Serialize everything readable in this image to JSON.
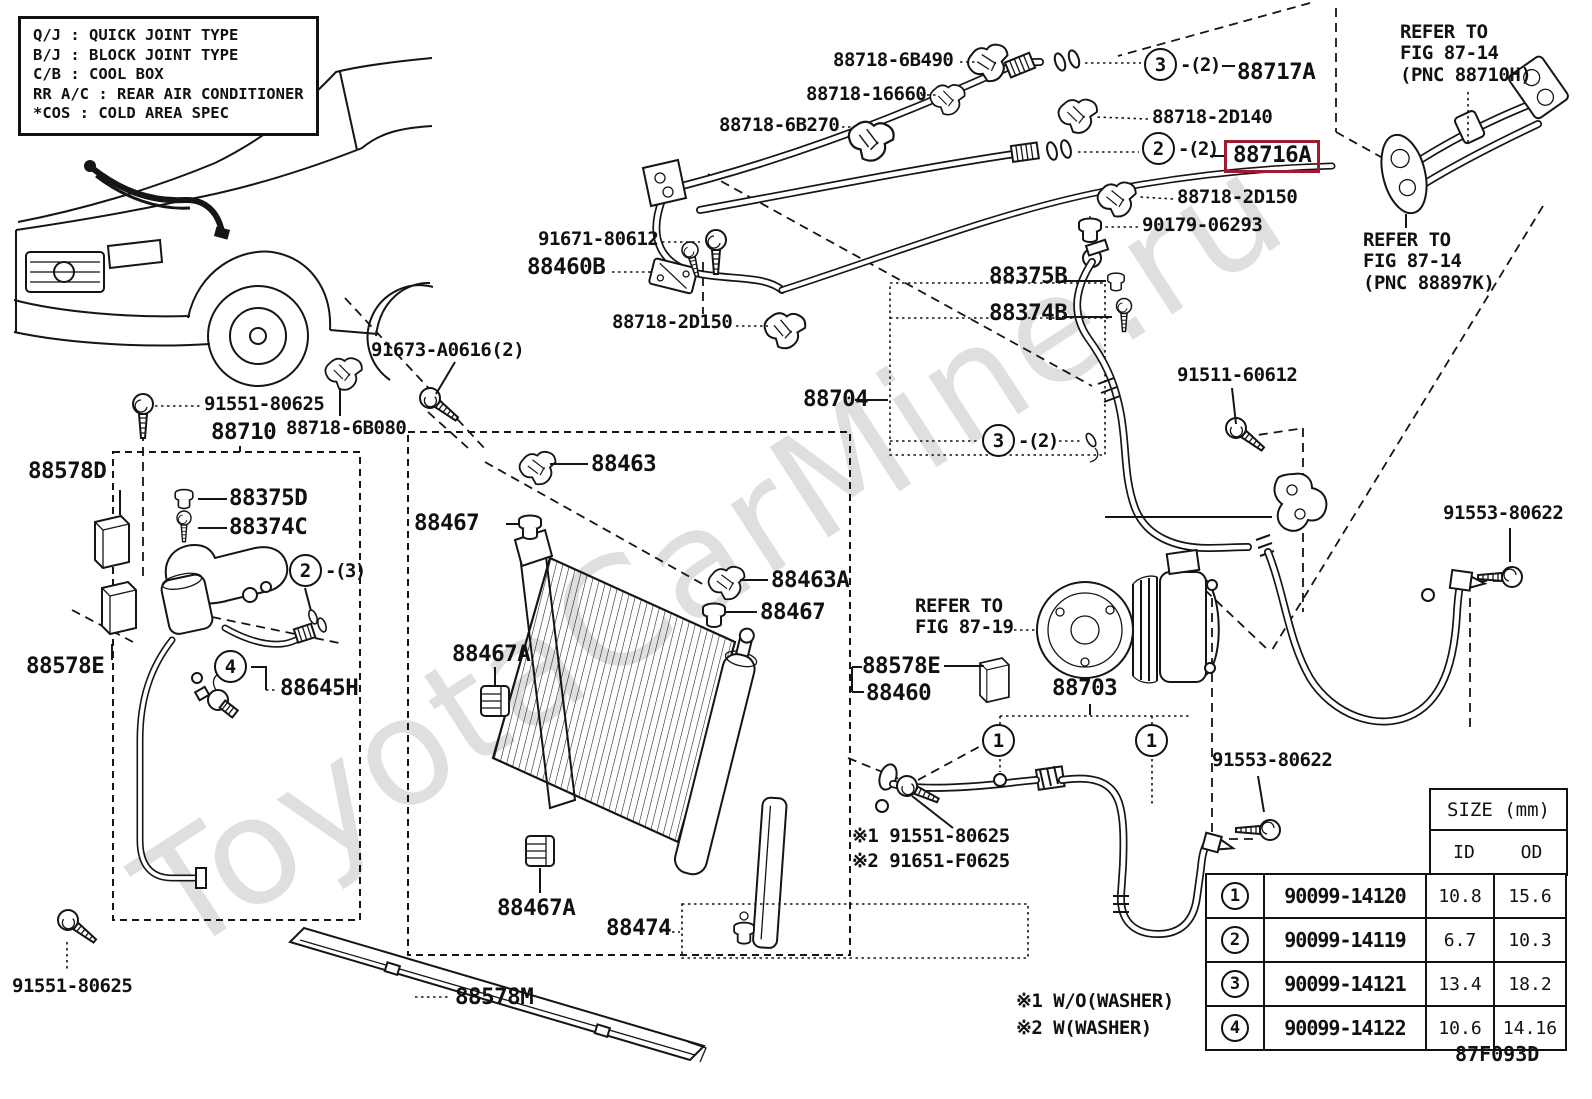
{
  "watermark": "ToyotaCarMine.ru",
  "fig_code": "87F093D",
  "highlight_color": "#a01931",
  "highlighted_part": "88716A",
  "legend": {
    "rows": [
      {
        "abbr": "Q/J",
        "desc": "QUICK JOINT TYPE"
      },
      {
        "abbr": "B/J",
        "desc": "BLOCK JOINT TYPE"
      },
      {
        "abbr": "C/B",
        "desc": "COOL BOX"
      },
      {
        "abbr": "RR A/C",
        "desc": "REAR AIR CONDITIONER"
      },
      {
        "abbr": "*COS",
        "desc": "COLD AREA SPEC"
      }
    ]
  },
  "notes": [
    "※1 W/O(WASHER)",
    "※2 W(WASHER)"
  ],
  "size_table": {
    "title": "SIZE (mm)",
    "columns": [
      "ID",
      "OD"
    ],
    "rows": [
      {
        "num": "1",
        "part_number": "90099-14120",
        "id": "10.8",
        "od": "15.6"
      },
      {
        "num": "2",
        "part_number": "90099-14119",
        "id": "6.7",
        "od": "10.3"
      },
      {
        "num": "3",
        "part_number": "90099-14121",
        "id": "13.4",
        "od": "18.2"
      },
      {
        "num": "4",
        "part_number": "90099-14122",
        "id": "10.6",
        "od": "14.16"
      }
    ]
  },
  "labels": [
    {
      "name": "part-label-88718-6b490",
      "text": "88718-6B490",
      "x": 833,
      "y": 50,
      "size": "md"
    },
    {
      "name": "part-label-88718-16660",
      "text": "88718-16660",
      "x": 806,
      "y": 84,
      "size": "md"
    },
    {
      "name": "part-label-88718-6b270",
      "text": "88718-6B270",
      "x": 719,
      "y": 115,
      "size": "md"
    },
    {
      "name": "part-label-88717a",
      "text": "88717A",
      "x": 1237,
      "y": 60,
      "size": "lg"
    },
    {
      "name": "part-label-88718-2d140",
      "text": "88718-2D140",
      "x": 1152,
      "y": 107,
      "size": "md"
    },
    {
      "name": "part-label-88716a",
      "text": "88716A",
      "x": 1224,
      "y": 140,
      "size": "lg",
      "highlight": true
    },
    {
      "name": "part-label-88718-2d150-right",
      "text": "88718-2D150",
      "x": 1177,
      "y": 187,
      "size": "md"
    },
    {
      "name": "part-label-90179-06293",
      "text": "90179-06293",
      "x": 1142,
      "y": 215,
      "size": "md"
    },
    {
      "name": "refer-note-fig-87-14-top",
      "text": "REFER TO\nFIG 87-14\n(PNC 88710H)",
      "x": 1400,
      "y": 22,
      "size": "md"
    },
    {
      "name": "refer-note-fig-87-14-bottom",
      "text": "REFER TO\nFIG 87-14\n(PNC 88897K)",
      "x": 1363,
      "y": 230,
      "size": "md"
    },
    {
      "name": "part-label-91671-80612",
      "text": "91671-80612",
      "x": 538,
      "y": 229,
      "size": "md"
    },
    {
      "name": "part-label-88460b",
      "text": "88460B",
      "x": 527,
      "y": 255,
      "size": "lg"
    },
    {
      "name": "part-label-88718-2d150-left",
      "text": "88718-2D150",
      "x": 612,
      "y": 312,
      "size": "md"
    },
    {
      "name": "part-label-88375b",
      "text": "88375B",
      "x": 989,
      "y": 264,
      "size": "lg"
    },
    {
      "name": "part-label-88374b",
      "text": "88374B",
      "x": 989,
      "y": 301,
      "size": "lg"
    },
    {
      "name": "part-label-88704",
      "text": "88704",
      "x": 803,
      "y": 387,
      "size": "lg"
    },
    {
      "name": "part-label-91511-60612",
      "text": "91511-60612",
      "x": 1177,
      "y": 365,
      "size": "md"
    },
    {
      "name": "part-label-91673-a0616",
      "text": "91673-A0616(2)",
      "x": 371,
      "y": 340,
      "size": "md"
    },
    {
      "name": "part-label-91551-80625-top",
      "text": "91551-80625",
      "x": 204,
      "y": 394,
      "size": "md"
    },
    {
      "name": "part-label-88710",
      "text": "88710",
      "x": 211,
      "y": 420,
      "size": "lg"
    },
    {
      "name": "part-label-88718-6b080",
      "text": "88718-6B080",
      "x": 286,
      "y": 418,
      "size": "md"
    },
    {
      "name": "part-label-88578d",
      "text": "88578D",
      "x": 28,
      "y": 459,
      "size": "lg"
    },
    {
      "name": "part-label-88375d",
      "text": "88375D",
      "x": 229,
      "y": 486,
      "size": "lg"
    },
    {
      "name": "part-label-88374c",
      "text": "88374C",
      "x": 229,
      "y": 515,
      "size": "lg"
    },
    {
      "name": "part-label-88578e-left",
      "text": "88578E",
      "x": 26,
      "y": 654,
      "size": "lg"
    },
    {
      "name": "part-label-88645h",
      "text": "88645H",
      "x": 280,
      "y": 676,
      "size": "lg"
    },
    {
      "name": "part-label-88463",
      "text": "88463",
      "x": 591,
      "y": 452,
      "size": "lg"
    },
    {
      "name": "part-label-88467-top",
      "text": "88467",
      "x": 414,
      "y": 511,
      "size": "lg"
    },
    {
      "name": "part-label-88463a",
      "text": "88463A",
      "x": 771,
      "y": 568,
      "size": "lg"
    },
    {
      "name": "part-label-88467-mid",
      "text": "88467",
      "x": 760,
      "y": 600,
      "size": "lg"
    },
    {
      "name": "part-label-88467a-left",
      "text": "88467A",
      "x": 452,
      "y": 642,
      "size": "lg"
    },
    {
      "name": "part-label-88467a-bottom",
      "text": "88467A",
      "x": 497,
      "y": 896,
      "size": "lg"
    },
    {
      "name": "part-label-88474",
      "text": "88474",
      "x": 606,
      "y": 916,
      "size": "lg"
    },
    {
      "name": "part-label-88578e-right",
      "text": "88578E",
      "x": 862,
      "y": 654,
      "size": "lg"
    },
    {
      "name": "part-label-88460",
      "text": "88460",
      "x": 866,
      "y": 681,
      "size": "lg"
    },
    {
      "name": "refer-note-fig-87-19",
      "text": "REFER TO\nFIG 87-19",
      "x": 915,
      "y": 596,
      "size": "md"
    },
    {
      "name": "part-label-88703",
      "text": "88703",
      "x": 1052,
      "y": 676,
      "size": "lg"
    },
    {
      "name": "note-part-91551-80625",
      "text": "※1 91551-80625",
      "x": 852,
      "y": 826,
      "size": "md"
    },
    {
      "name": "note-part-91651-f0625",
      "text": "※2 91651-F0625",
      "x": 852,
      "y": 851,
      "size": "md"
    },
    {
      "name": "part-label-91553-80622-top",
      "text": "91553-80622",
      "x": 1443,
      "y": 503,
      "size": "md"
    },
    {
      "name": "part-label-91553-80622-bottom",
      "text": "91553-80622",
      "x": 1212,
      "y": 750,
      "size": "md"
    },
    {
      "name": "part-label-91551-80625-bottom",
      "text": "91551-80625",
      "x": 12,
      "y": 976,
      "size": "md"
    },
    {
      "name": "part-label-88578m",
      "text": "88578M",
      "x": 455,
      "y": 985,
      "size": "lg"
    }
  ],
  "callouts": [
    {
      "name": "callout-3-top",
      "num": "3",
      "suffix": "-(2)",
      "x": 1144,
      "y": 48
    },
    {
      "name": "callout-2-mid",
      "num": "2",
      "suffix": "-(2)",
      "x": 1142,
      "y": 132
    },
    {
      "name": "callout-3-lower",
      "num": "3",
      "suffix": "-(2)",
      "x": 982,
      "y": 424
    },
    {
      "name": "callout-2-left",
      "num": "2",
      "suffix": "-(3)",
      "x": 289,
      "y": 554
    },
    {
      "name": "callout-4",
      "num": "4",
      "suffix": "",
      "x": 214,
      "y": 650
    },
    {
      "name": "callout-1-left",
      "num": "1",
      "suffix": "",
      "x": 982,
      "y": 724
    },
    {
      "name": "callout-1-right",
      "num": "1",
      "suffix": "",
      "x": 1135,
      "y": 724
    }
  ]
}
